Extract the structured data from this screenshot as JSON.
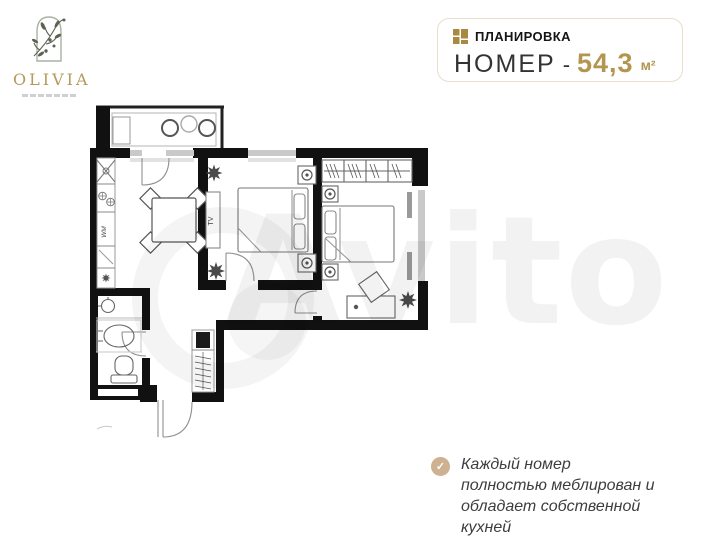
{
  "logo": {
    "name": "OLIVIA"
  },
  "header": {
    "eyebrow": "ПЛАНИРОВКА",
    "room_label": "НОМЕР",
    "dash": "-",
    "area": "54,3",
    "unit": "м²"
  },
  "plan": {
    "tv_label": "TV",
    "wm_label": "WM"
  },
  "feature": {
    "check_glyph": "✓",
    "text": "Каждый номер полностью меблирован и обладает собственной кухней"
  },
  "watermark": {
    "text": "Avito"
  },
  "colors": {
    "accent_gold": "#b3954f",
    "icon_gold": "#a8893f",
    "box_border_tan": "#e9dec9",
    "check_tan": "#cdb190",
    "wall_black": "#111111"
  }
}
